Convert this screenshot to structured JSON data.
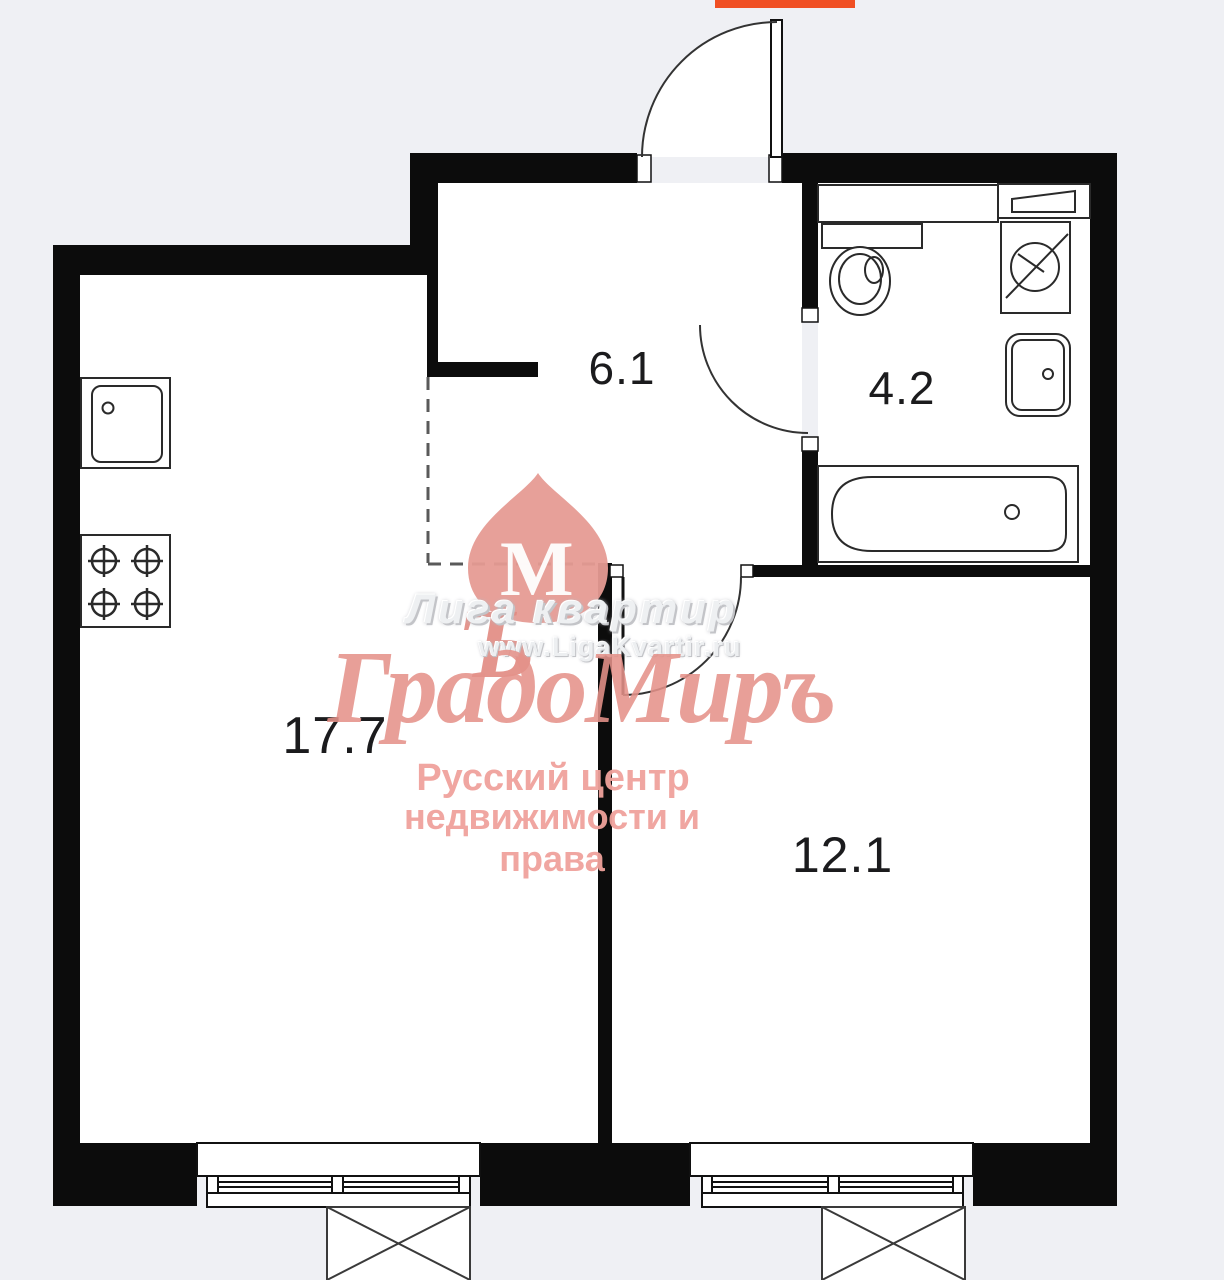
{
  "plan": {
    "rooms": [
      {
        "id": "hallway",
        "area_label": "6.1"
      },
      {
        "id": "bathroom",
        "area_label": "4.2"
      },
      {
        "id": "kitchen-living-room",
        "area_label": "17.7"
      },
      {
        "id": "bedroom",
        "area_label": "12.1"
      }
    ],
    "icons": [
      "kitchen-sink-icon",
      "stove-icon",
      "toilet-icon",
      "shelf-icon",
      "washing-machine-icon",
      "washbasin-icon",
      "bathtub-icon",
      "window-icon",
      "crossed-box-icon",
      "door-swing-arc-icon"
    ],
    "colors": {
      "wall": "#0c0c0c",
      "floor": "#ffffff",
      "background": "#eff0f4",
      "fixture_outline": "#2a2a2a",
      "label": "#1b1b1d",
      "accent_line": "#f04f23",
      "dashed_boundary": "#5a5a5a"
    }
  },
  "watermark": {
    "agency": "Лига квартир",
    "url": "www.LigaKvartir.ru",
    "brand": "ГрадоМиръ",
    "logo_letter_m": "М",
    "logo_letter_hard_sign": "Ъ",
    "tagline_line1": "Русский центр",
    "tagline_line2": "недвижимости и права",
    "brand_color": "#e5928a",
    "emboss_color": "#eef0f2"
  }
}
